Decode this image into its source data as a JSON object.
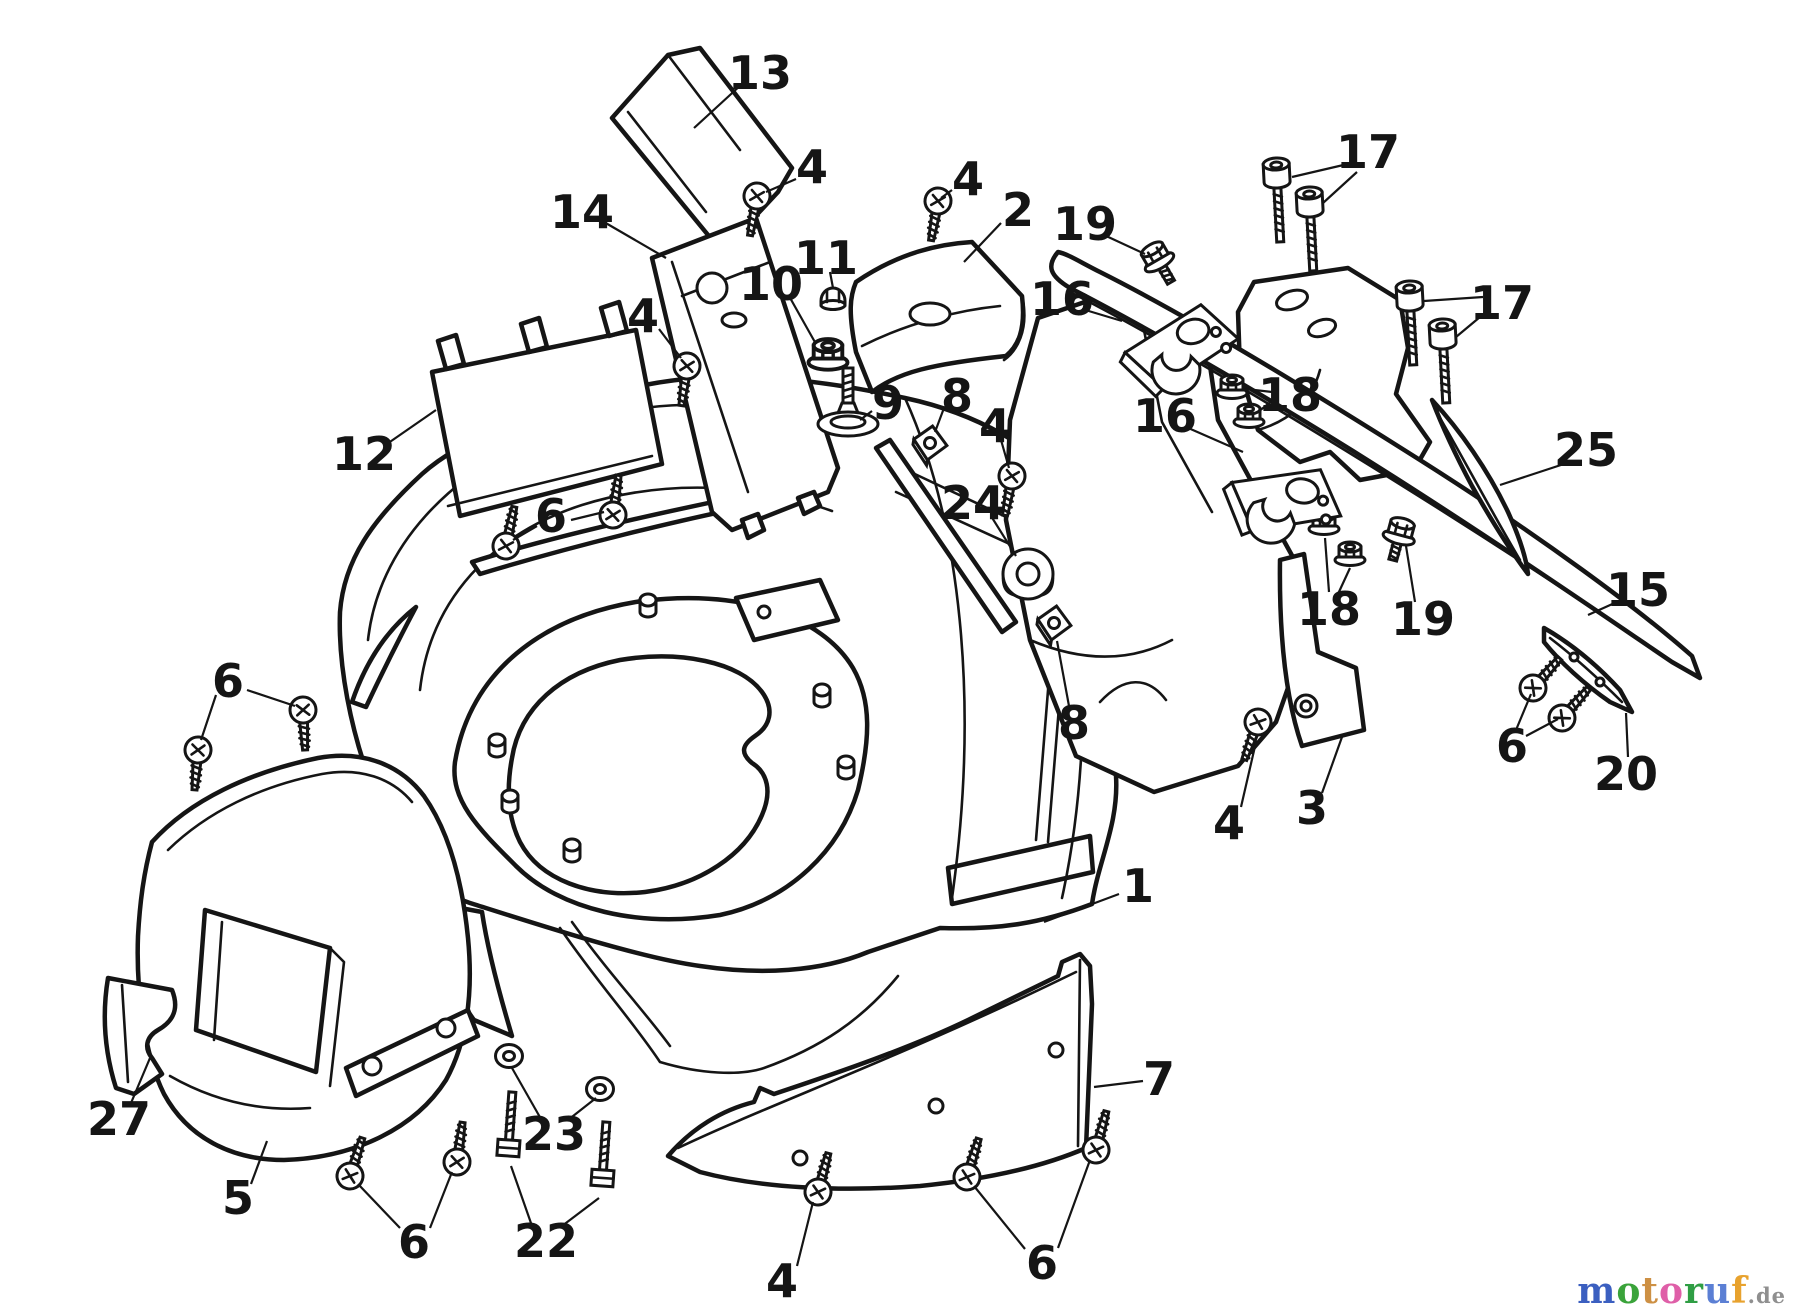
{
  "figure": {
    "background": "#ffffff",
    "line_color": "#151515",
    "description_icon": "exploded-parts-diagram"
  },
  "watermark": {
    "letters": [
      {
        "ch": "m",
        "color": "#3b5fc0"
      },
      {
        "ch": "o",
        "color": "#3aa33a"
      },
      {
        "ch": "t",
        "color": "#cd9044"
      },
      {
        "ch": "o",
        "color": "#df5fa8"
      },
      {
        "ch": "r",
        "color": "#2f9e44"
      },
      {
        "ch": "u",
        "color": "#5b7fd4"
      },
      {
        "ch": "f",
        "color": "#e8a22e"
      }
    ],
    "tld": {
      "text": ".de",
      "color": "#8f8f8f"
    }
  },
  "callouts": [
    {
      "num": "13",
      "x": 760,
      "y": 73,
      "leaders": [
        [
          742,
          84,
          694,
          128
        ]
      ]
    },
    {
      "num": "4",
      "x": 812,
      "y": 167,
      "leaders": [
        [
          796,
          179,
          766,
          192
        ]
      ]
    },
    {
      "num": "4",
      "x": 968,
      "y": 179,
      "leaders": [
        [
          952,
          190,
          941,
          198
        ]
      ]
    },
    {
      "num": "2",
      "x": 1018,
      "y": 210,
      "leaders": [
        [
          1001,
          223,
          964,
          262
        ]
      ]
    },
    {
      "num": "19",
      "x": 1085,
      "y": 224,
      "leaders": [
        [
          1104,
          235,
          1145,
          254
        ]
      ]
    },
    {
      "num": "16",
      "x": 1062,
      "y": 299,
      "leaders": [
        [
          1082,
          309,
          1122,
          321
        ]
      ]
    },
    {
      "num": "17",
      "x": 1368,
      "y": 152,
      "leaders": [
        [
          1352,
          163,
          1292,
          177
        ],
        [
          1357,
          172,
          1323,
          203
        ]
      ]
    },
    {
      "num": "17",
      "x": 1502,
      "y": 303,
      "leaders": [
        [
          1483,
          297,
          1424,
          301
        ],
        [
          1486,
          312,
          1456,
          337
        ]
      ]
    },
    {
      "num": "14",
      "x": 582,
      "y": 212,
      "leaders": [
        [
          604,
          222,
          666,
          258
        ]
      ]
    },
    {
      "num": "11",
      "x": 826,
      "y": 258,
      "leaders": [
        [
          830,
          272,
          833,
          288
        ]
      ]
    },
    {
      "num": "10",
      "x": 771,
      "y": 284,
      "leaders": [
        [
          789,
          296,
          816,
          344
        ]
      ]
    },
    {
      "num": "12",
      "x": 364,
      "y": 454,
      "leaders": [
        [
          384,
          446,
          436,
          410
        ]
      ]
    },
    {
      "num": "4",
      "x": 643,
      "y": 316,
      "leaders": [
        [
          659,
          329,
          681,
          358
        ]
      ]
    },
    {
      "num": "9",
      "x": 888,
      "y": 403,
      "leaders": [
        [
          872,
          411,
          860,
          420
        ]
      ]
    },
    {
      "num": "8",
      "x": 957,
      "y": 396,
      "leaders": [
        [
          944,
          408,
          935,
          432
        ]
      ]
    },
    {
      "num": "4",
      "x": 995,
      "y": 426,
      "leaders": [
        [
          1001,
          440,
          1009,
          468
        ]
      ]
    },
    {
      "num": "24",
      "x": 973,
      "y": 503,
      "leaders": [
        [
          991,
          516,
          1016,
          556
        ]
      ]
    },
    {
      "num": "16",
      "x": 1165,
      "y": 416,
      "leaders": [
        [
          1186,
          427,
          1243,
          452
        ]
      ]
    },
    {
      "num": "18",
      "x": 1290,
      "y": 395,
      "leaders": [
        [
          1272,
          392,
          1246,
          389
        ],
        [
          1273,
          400,
          1258,
          412
        ]
      ]
    },
    {
      "num": "18",
      "x": 1329,
      "y": 609,
      "leaders": [
        [
          1329,
          592,
          1325,
          538
        ],
        [
          1338,
          594,
          1350,
          568
        ]
      ]
    },
    {
      "num": "19",
      "x": 1423,
      "y": 619,
      "leaders": [
        [
          1415,
          602,
          1406,
          546
        ]
      ]
    },
    {
      "num": "25",
      "x": 1586,
      "y": 450,
      "leaders": [
        [
          1567,
          463,
          1500,
          485
        ]
      ]
    },
    {
      "num": "15",
      "x": 1638,
      "y": 590,
      "leaders": [
        [
          1619,
          601,
          1588,
          615
        ]
      ]
    },
    {
      "num": "8",
      "x": 1074,
      "y": 723,
      "leaders": [
        [
          1069,
          706,
          1057,
          641
        ]
      ]
    },
    {
      "num": "3",
      "x": 1312,
      "y": 808,
      "leaders": [
        [
          1322,
          793,
          1342,
          737
        ]
      ]
    },
    {
      "num": "4",
      "x": 1229,
      "y": 823,
      "leaders": [
        [
          1241,
          807,
          1256,
          742
        ]
      ]
    },
    {
      "num": "6",
      "x": 1512,
      "y": 746,
      "leaders": [
        [
          1516,
          730,
          1531,
          694
        ],
        [
          1526,
          736,
          1558,
          719
        ]
      ]
    },
    {
      "num": "20",
      "x": 1626,
      "y": 774,
      "leaders": [
        [
          1628,
          757,
          1626,
          713
        ]
      ]
    },
    {
      "num": "1",
      "x": 1138,
      "y": 886,
      "leaders": [
        [
          1119,
          894,
          1044,
          922
        ]
      ]
    },
    {
      "num": "7",
      "x": 1159,
      "y": 1079,
      "leaders": [
        [
          1143,
          1081,
          1094,
          1087
        ]
      ]
    },
    {
      "num": "27",
      "x": 119,
      "y": 1119,
      "leaders": [
        [
          131,
          1103,
          150,
          1058
        ]
      ]
    },
    {
      "num": "5",
      "x": 238,
      "y": 1198,
      "leaders": [
        [
          251,
          1184,
          267,
          1141
        ]
      ]
    },
    {
      "num": "23",
      "x": 554,
      "y": 1134,
      "leaders": [
        [
          541,
          1119,
          512,
          1068
        ],
        [
          568,
          1120,
          596,
          1098
        ]
      ]
    },
    {
      "num": "22",
      "x": 546,
      "y": 1241,
      "leaders": [
        [
          532,
          1226,
          511,
          1166
        ],
        [
          562,
          1226,
          599,
          1198
        ]
      ]
    },
    {
      "num": "6",
      "x": 414,
      "y": 1242,
      "leaders": [
        [
          400,
          1228,
          358,
          1184
        ],
        [
          430,
          1228,
          452,
          1172
        ]
      ]
    },
    {
      "num": "4",
      "x": 782,
      "y": 1281,
      "leaders": [
        [
          797,
          1266,
          813,
          1202
        ]
      ]
    },
    {
      "num": "6",
      "x": 1042,
      "y": 1263,
      "leaders": [
        [
          1025,
          1249,
          974,
          1186
        ],
        [
          1058,
          1248,
          1090,
          1160
        ]
      ]
    },
    {
      "num": "6",
      "x": 228,
      "y": 681,
      "leaders": [
        [
          216,
          695,
          201,
          740
        ],
        [
          247,
          690,
          295,
          706
        ]
      ]
    },
    {
      "num": "6",
      "x": 551,
      "y": 516,
      "leaders": [
        [
          537,
          526,
          513,
          540
        ],
        [
          571,
          520,
          604,
          512
        ]
      ]
    }
  ],
  "hardware": [
    {
      "type": "pan-screw",
      "x": 757,
      "y": 196,
      "rot": 10
    },
    {
      "type": "pan-screw",
      "x": 938,
      "y": 201,
      "rot": 10
    },
    {
      "type": "pan-screw",
      "x": 687,
      "y": 366,
      "rot": 8
    },
    {
      "type": "pan-screw",
      "x": 1012,
      "y": 476,
      "rot": 10
    },
    {
      "type": "pan-screw",
      "x": 1258,
      "y": 722,
      "rot": 20
    },
    {
      "type": "pan-screw",
      "x": 818,
      "y": 1192,
      "rot": 195
    },
    {
      "type": "pan-screw",
      "x": 198,
      "y": 750,
      "rot": 5
    },
    {
      "type": "pan-screw",
      "x": 303,
      "y": 710,
      "rot": -3
    },
    {
      "type": "pan-screw",
      "x": 506,
      "y": 546,
      "rot": 192
    },
    {
      "type": "pan-screw",
      "x": 613,
      "y": 515,
      "rot": 188
    },
    {
      "type": "pan-screw",
      "x": 350,
      "y": 1176,
      "rot": 198
    },
    {
      "type": "pan-screw",
      "x": 457,
      "y": 1162,
      "rot": 188
    },
    {
      "type": "pan-screw",
      "x": 967,
      "y": 1177,
      "rot": 197
    },
    {
      "type": "pan-screw",
      "x": 1096,
      "y": 1150,
      "rot": 195
    },
    {
      "type": "pan-screw",
      "x": 1533,
      "y": 688,
      "rot": 222
    },
    {
      "type": "pan-screw",
      "x": 1562,
      "y": 718,
      "rot": 222
    },
    {
      "type": "socket-screw",
      "x": 1277,
      "y": 180,
      "rot": -3
    },
    {
      "type": "socket-screw",
      "x": 1310,
      "y": 209,
      "rot": -3
    },
    {
      "type": "socket-screw",
      "x": 1410,
      "y": 303,
      "rot": -3
    },
    {
      "type": "socket-screw",
      "x": 1443,
      "y": 341,
      "rot": -3
    },
    {
      "type": "flange-bolt",
      "x": 1157,
      "y": 258,
      "rot": -30
    },
    {
      "type": "flange-bolt",
      "x": 1400,
      "y": 533,
      "rot": 15
    },
    {
      "type": "cap-nut",
      "x": 833,
      "y": 298,
      "rot": 0
    },
    {
      "type": "flange-nut",
      "x": 828,
      "y": 356,
      "rot": 0,
      "scale": 1.3
    },
    {
      "type": "flange-nut",
      "x": 1232,
      "y": 388,
      "rot": 0
    },
    {
      "type": "flange-nut",
      "x": 1249,
      "y": 417,
      "rot": 0
    },
    {
      "type": "flange-nut",
      "x": 1324,
      "y": 524,
      "rot": 0
    },
    {
      "type": "flange-nut",
      "x": 1350,
      "y": 555,
      "rot": 0
    },
    {
      "type": "square-nut",
      "x": 930,
      "y": 443,
      "rot": -12
    },
    {
      "type": "square-nut",
      "x": 1054,
      "y": 623,
      "rot": -12
    },
    {
      "type": "carriage-bolt",
      "x": 509,
      "y": 1140,
      "rot": 4
    },
    {
      "type": "carriage-bolt",
      "x": 603,
      "y": 1170,
      "rot": 4
    },
    {
      "type": "washer",
      "x": 509,
      "y": 1056,
      "rot": 0
    },
    {
      "type": "washer",
      "x": 600,
      "y": 1089,
      "rot": 0
    },
    {
      "type": "bushing",
      "x": 1028,
      "y": 574,
      "rot": 0
    },
    {
      "type": "shoulder-bolt",
      "x": 848,
      "y": 424,
      "rot": 0
    },
    {
      "type": "stud",
      "x": 497,
      "y": 740,
      "rot": 0
    },
    {
      "type": "stud",
      "x": 510,
      "y": 796,
      "rot": 0
    },
    {
      "type": "stud",
      "x": 572,
      "y": 845,
      "rot": 0
    },
    {
      "type": "stud",
      "x": 648,
      "y": 600,
      "rot": 0
    },
    {
      "type": "stud",
      "x": 822,
      "y": 690,
      "rot": 0
    },
    {
      "type": "stud",
      "x": 846,
      "y": 762,
      "rot": 0
    },
    {
      "type": "hinge",
      "x": 1180,
      "y": 345,
      "rot": -14
    },
    {
      "type": "hinge",
      "x": 1285,
      "y": 498,
      "rot": 10
    }
  ]
}
